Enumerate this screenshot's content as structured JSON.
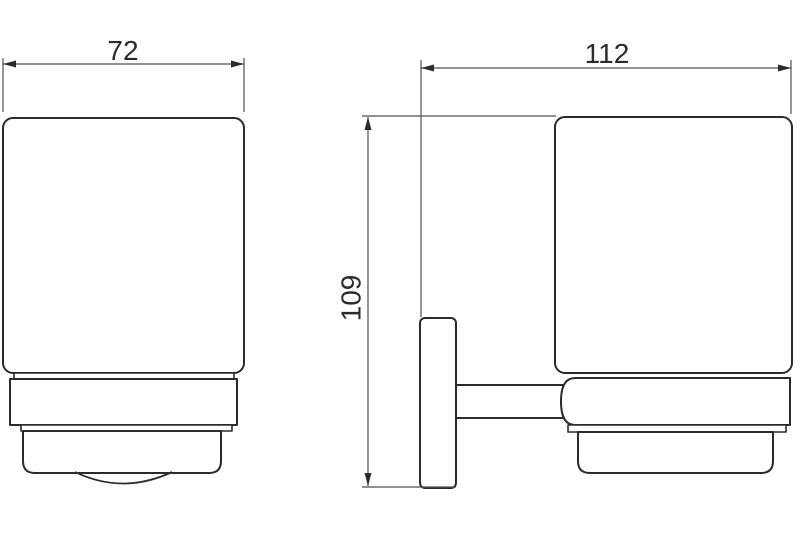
{
  "page": {
    "background": "#ffffff"
  },
  "drawing": {
    "kind": "technical-dimension-drawing",
    "subject": "wall-mounted-tumbler-holder",
    "colors": {
      "object_line": "#2b2b2b",
      "dimension_line": "#4f4f4f",
      "text": "#2b2b2b"
    },
    "dimensions": {
      "width": {
        "label": "72",
        "axis": "horizontal",
        "view": "front"
      },
      "depth": {
        "label": "112",
        "axis": "horizontal",
        "view": "side"
      },
      "height": {
        "label": "109",
        "axis": "vertical",
        "view": "side"
      }
    }
  }
}
